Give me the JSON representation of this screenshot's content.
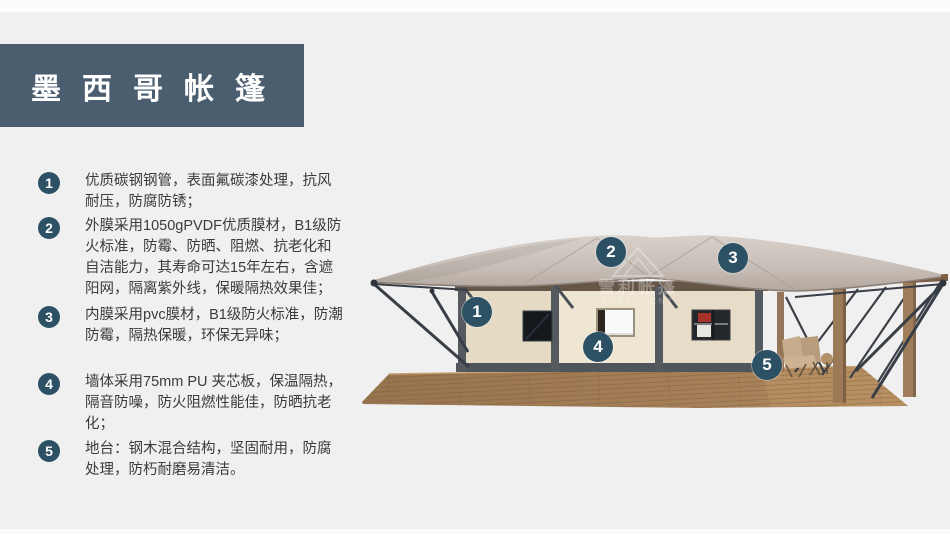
{
  "header": {
    "title": "墨西哥帐篷"
  },
  "features": {
    "items": [
      {
        "number": "1",
        "text": "优质碳钢钢管，表面氟碳漆处理，抗风耐压，防腐防锈；"
      },
      {
        "number": "2",
        "text": "外膜采用1050gPVDF优质膜材，B1级防火标准，防霉、防晒、阻燃、抗老化和自洁能力，其寿命可达15年左右，含遮阳网，隔离紫外线，保暖隔热效果佳；"
      },
      {
        "number": "3",
        "text": "内膜采用pvc膜材，B1级防火标准，防潮防霉，隔热保暖，环保无异味；"
      },
      {
        "number": "4",
        "text": "墙体采用75mm PU 夹芯板，保温隔热，隔音防噪，防火阻燃性能佳，防晒抗老化；"
      },
      {
        "number": "5",
        "text": "地台：钢木混合结构，坚固耐用，防腐处理，防朽耐磨易清洁。"
      }
    ]
  },
  "illustration": {
    "watermark": {
      "line1": "雪利帐篷",
      "line2": "XUELI TENT"
    },
    "callouts": [
      {
        "number": "1"
      },
      {
        "number": "2"
      },
      {
        "number": "3"
      },
      {
        "number": "4"
      },
      {
        "number": "5"
      }
    ]
  },
  "theme": {
    "banner_color": "#4b5e70",
    "badge_color": "#2d5164",
    "background_color": "#f0f0f1",
    "text_color": "#3b3b3b",
    "roof_light": "#d8d0ca",
    "roof_shade": "#b3a79e",
    "wall_color": "#e9dfcb",
    "frame_color": "#555960",
    "deck_wood": "#a07c58"
  }
}
